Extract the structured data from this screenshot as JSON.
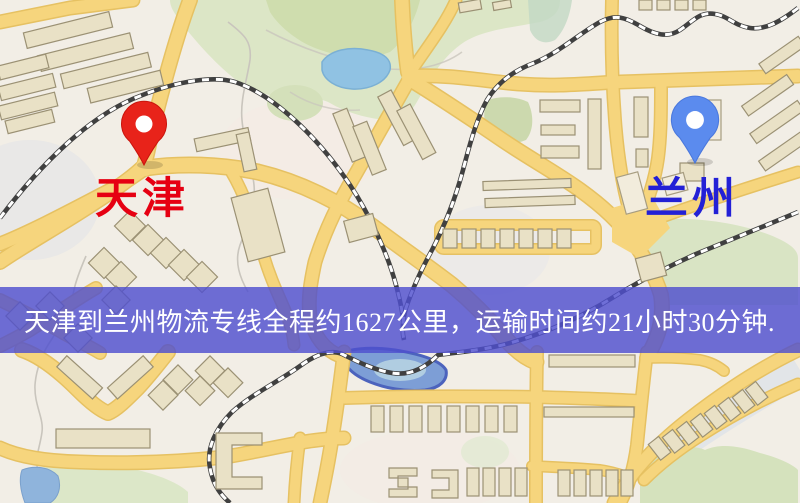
{
  "banner": {
    "text": "天津到兰州物流专线全程约1627公里，运输时间约21小时30分钟."
  },
  "markers": {
    "origin": {
      "label": "天津"
    },
    "destination": {
      "label": "兰州"
    }
  },
  "colors": {
    "banner_bg": "#4f4fce",
    "banner_text": "#ffffff",
    "origin_label": "#e60012",
    "destination_label": "#2320d6",
    "origin_pin": "#e8231a",
    "destination_pin": "#5b8bee",
    "road": "#f6d57d",
    "park": "#dce6c6",
    "water": "#90c2e3",
    "railway": "#404040",
    "map_background": "#f2eee6"
  }
}
